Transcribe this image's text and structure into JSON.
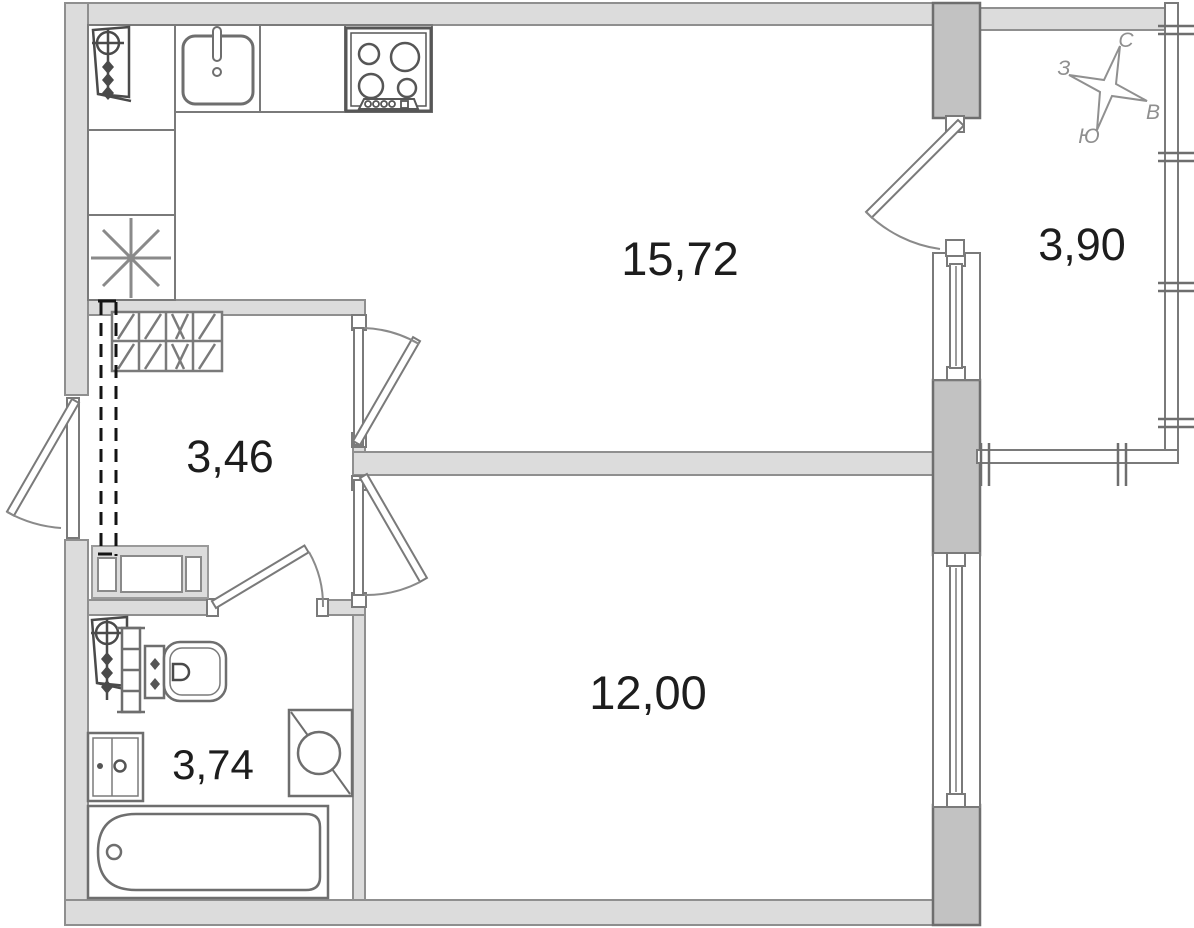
{
  "rooms": {
    "living_kitchen": {
      "area": "15,72"
    },
    "hallway": {
      "area": "3,46"
    },
    "bathroom": {
      "area": "3,74"
    },
    "bedroom": {
      "area": "12,00"
    },
    "balcony": {
      "area": "3,90"
    }
  },
  "compass": {
    "north": "С",
    "east": "В",
    "south": "Ю",
    "west": "З"
  },
  "colors": {
    "wall": "#dcdcdc",
    "pilaster": "#c2c2c2",
    "outline": "#8f8f8f",
    "fixture_stroke": "#6e6e6e",
    "label": "#1d1d1d",
    "compass": "#8f8f8f",
    "dashed_line": "#141414"
  },
  "fixtures": [
    "sink-icon",
    "stove-icon",
    "fridge-icon",
    "heating-riser-icon",
    "wardrobe-icon",
    "bench-icon",
    "towel-rail-icon",
    "toilet-icon",
    "vanity-icon",
    "washing-machine-icon",
    "bathtub-icon",
    "compass-rose-icon"
  ]
}
